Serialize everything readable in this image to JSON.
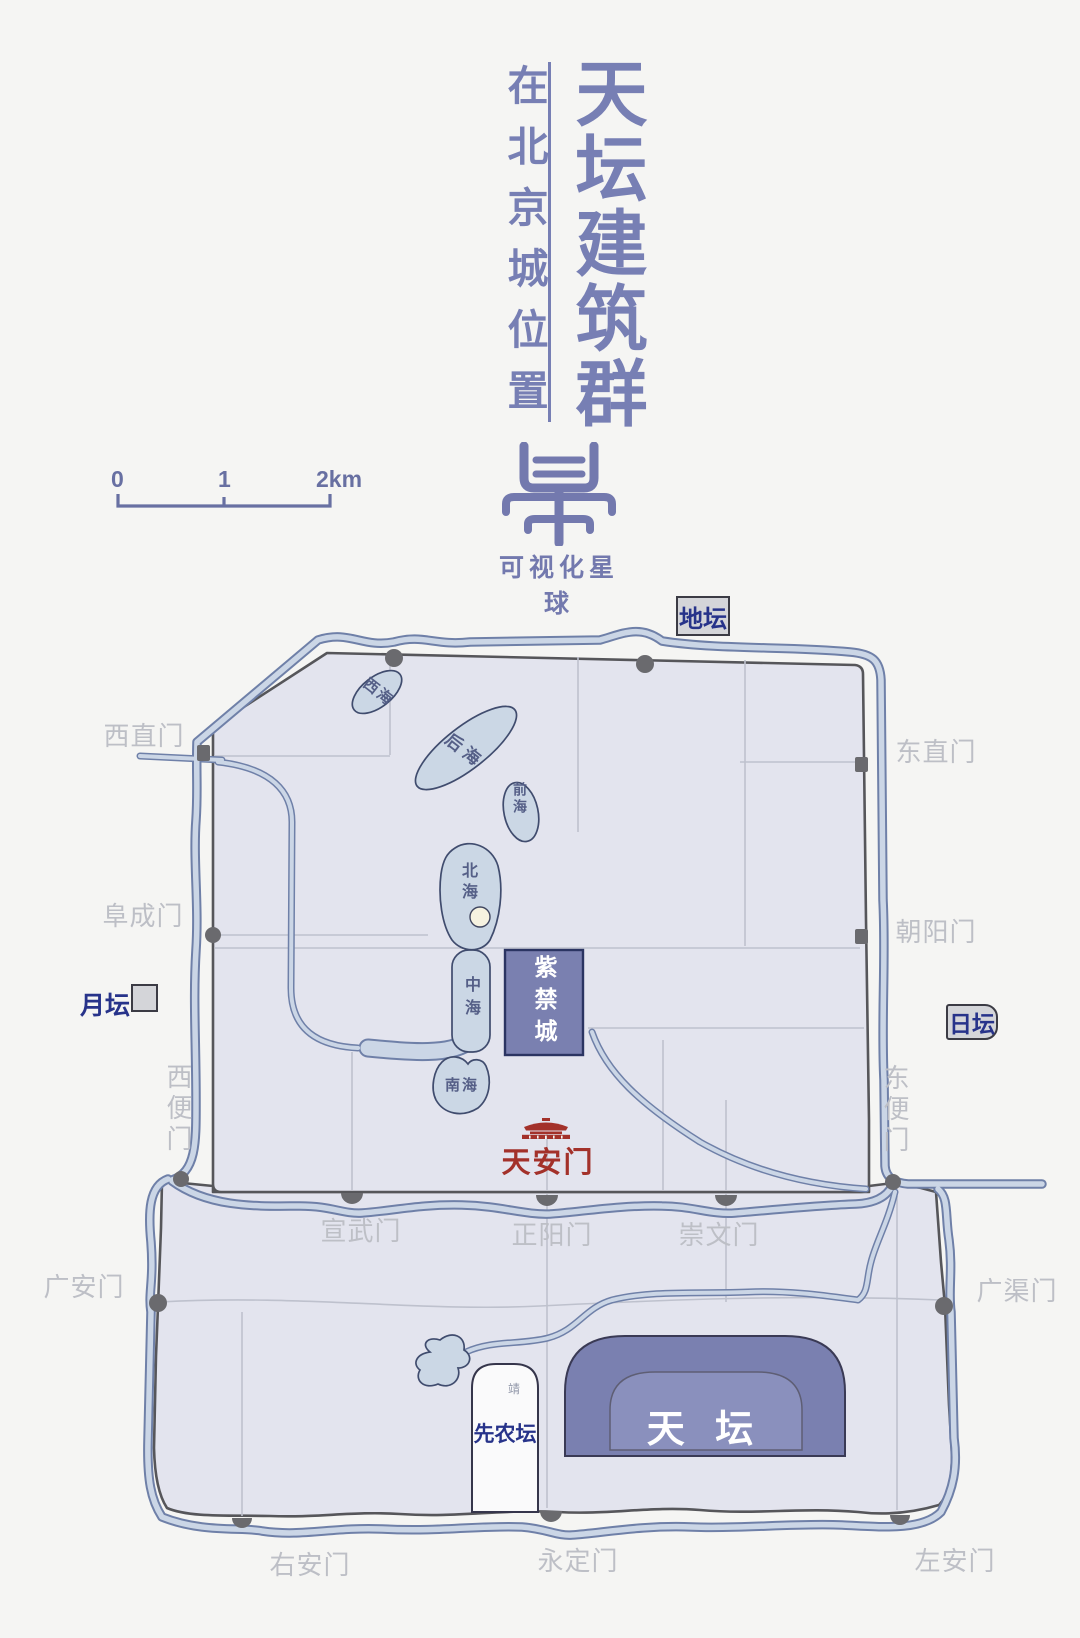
{
  "header": {
    "title": "天坛建筑群",
    "subtitle": "在北京城位置",
    "brand": "可视化星球",
    "logo_char": "星"
  },
  "scale_bar": {
    "t0": "0",
    "t1": "1",
    "t2": "2km"
  },
  "map": {
    "altars": {
      "ditan": "地坛",
      "ritan": "日坛",
      "yuetan": "月坛",
      "xiannongtan": "先农坛",
      "tiantan": "天 坛",
      "xiannongtan_mark": "靖"
    },
    "landmarks": {
      "zijincheng": "紫禁城",
      "tiananmen": "天安门"
    },
    "lakes": {
      "xihai": "西海",
      "houhai": "后海",
      "qianhai": "前海",
      "beihai": "北海",
      "zhonghai": "中海",
      "nanhai": "南海"
    },
    "gates": {
      "xizhimen": "西直门",
      "dongzhimen": "东直门",
      "fuchengmen": "阜成门",
      "chaoyangmen": "朝阳门",
      "xibianmen": "西便门",
      "dongbianmen": "东便门",
      "xuanwumen": "宣武门",
      "zhengyangmen": "正阳门",
      "chongwenmen": "崇文门",
      "guanganmen": "广安门",
      "guangqumen": "广渠门",
      "youanmen": "右安门",
      "yongdingmen": "永定门",
      "zuoanmen": "左安门"
    },
    "colors": {
      "temple_purple": "#7A80B0",
      "temple_inner": "#8A90BD",
      "city_fill": "#E3E4EE",
      "wall_gray": "#56565A",
      "water_fill": "#CBD6E6",
      "water_edge": "#6F80A8",
      "red_accent": "#A3312A",
      "label_navy": "#27338A",
      "gate_label_gray": "#BDBFC6",
      "title_blue": "#777FB4"
    }
  }
}
